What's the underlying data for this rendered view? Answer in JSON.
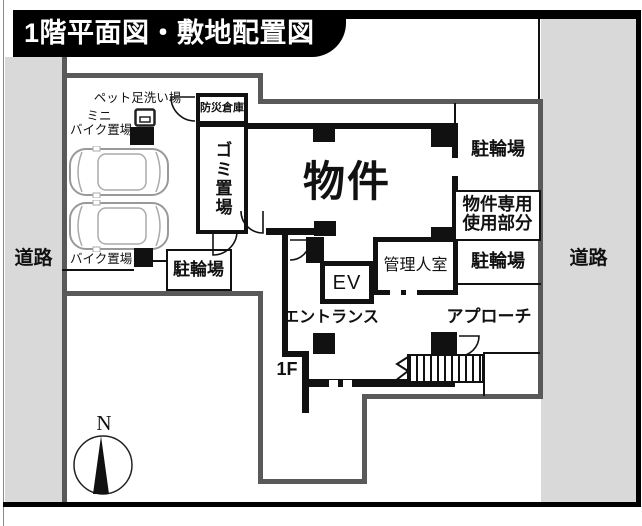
{
  "title": "1階平面図・敷地配置図",
  "colors": {
    "road_gray": "#d9d9d9",
    "site_boundary": "#595959",
    "wall_black": "#111111",
    "title_bg": "#000000"
  },
  "roads": {
    "left": "道路",
    "right": "道路"
  },
  "site": {
    "pet_wash_label": "ペット足洗い場",
    "mini_bike_line1": "ミニ",
    "mini_bike_line2": "バイク置場",
    "bike_label": "バイク置場",
    "bicycle_parking_left": "駐輪場",
    "bicycle_parking_top": "駐輪場",
    "bicycle_parking_mid": "駐輪場",
    "exclusive_use_line1": "物件専用",
    "exclusive_use_line2": "使用部分",
    "approach_label": "アプローチ",
    "compass_north": "N"
  },
  "building": {
    "main_label": "物件",
    "disaster_storage": "防災倉庫",
    "garbage_area": "ゴミ置場",
    "elevator": "EV",
    "manager_room": "管理人室",
    "entrance": "エントランス",
    "floor_label": "1F"
  }
}
